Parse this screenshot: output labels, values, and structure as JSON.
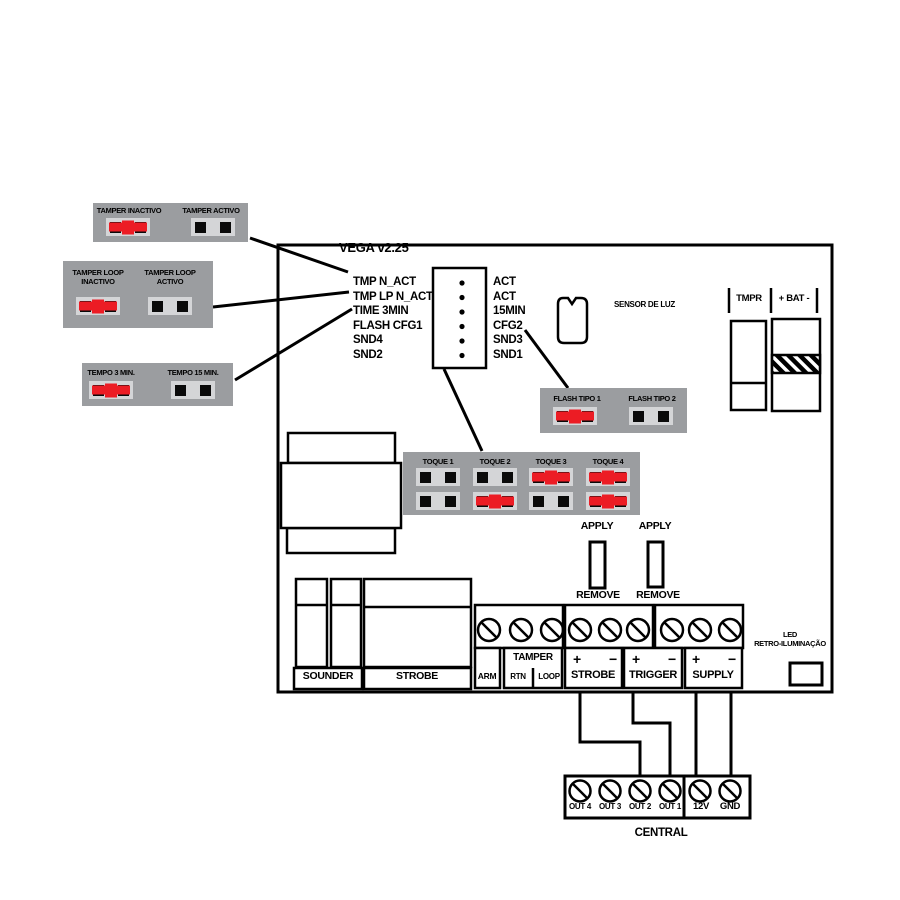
{
  "colors": {
    "red": "#ec1c24",
    "box-gray": "#9b9da0",
    "well-gray": "#d4d5d7"
  },
  "board": {
    "title": "VEGA v2.25"
  },
  "config_boxes": [
    {
      "name": "tamper",
      "options": [
        {
          "label": "TAMPER INACTIVO",
          "closed": true
        },
        {
          "label": "TAMPER ACTIVO",
          "closed": false
        }
      ]
    },
    {
      "name": "tamper-loop",
      "options": [
        {
          "label": "TAMPER LOOP\nINACTIVO",
          "closed": true
        },
        {
          "label": "TAMPER LOOP\nACTIVO",
          "closed": false
        }
      ]
    },
    {
      "name": "tempo",
      "options": [
        {
          "label": "TEMPO 3 MIN.",
          "closed": true
        },
        {
          "label": "TEMPO 15 MIN.",
          "closed": false
        }
      ]
    },
    {
      "name": "flash",
      "options": [
        {
          "label": "FLASH TIPO 1",
          "closed": true
        },
        {
          "label": "FLASH TIPO 2",
          "closed": false
        }
      ]
    }
  ],
  "toque": {
    "columns": [
      {
        "label": "TOQUE 1",
        "top": false,
        "bottom": false
      },
      {
        "label": "TOQUE 2",
        "top": false,
        "bottom": true
      },
      {
        "label": "TOQUE 3",
        "top": true,
        "bottom": false
      },
      {
        "label": "TOQUE 4",
        "top": true,
        "bottom": true
      }
    ]
  },
  "pin_header": {
    "left": [
      "TMP N_ACT",
      "TMP LP N_ACT",
      "TIME 3MIN",
      "FLASH CFG1",
      "SND4",
      "SND2"
    ],
    "right": [
      "ACT",
      "ACT",
      "15MIN",
      "CFG2",
      "SND3",
      "SND1"
    ]
  },
  "sensor_label": "SENSOR DE LUZ",
  "tamper_battery": {
    "tmpr": "TMPR",
    "bat": "+ BAT -"
  },
  "apply_remove": {
    "apply": "APPLY",
    "remove": "REMOVE"
  },
  "terminal_strip": {
    "arm": "ARM",
    "tamper": "TAMPER",
    "rtn": "RTN",
    "loop": "LOOP",
    "strobe": "STROBE",
    "trigger": "TRIGGER",
    "supply": "SUPPLY",
    "plus": "+",
    "minus": "−"
  },
  "devices": {
    "sounder": "SOUNDER",
    "strobe": "STROBE"
  },
  "led_label": "LED\nRETRO-ILUMINAÇÃO",
  "central": {
    "title": "CENTRAL",
    "terminals": [
      "OUT 4",
      "OUT 3",
      "OUT 2",
      "OUT 1",
      "12V",
      "GND"
    ]
  }
}
